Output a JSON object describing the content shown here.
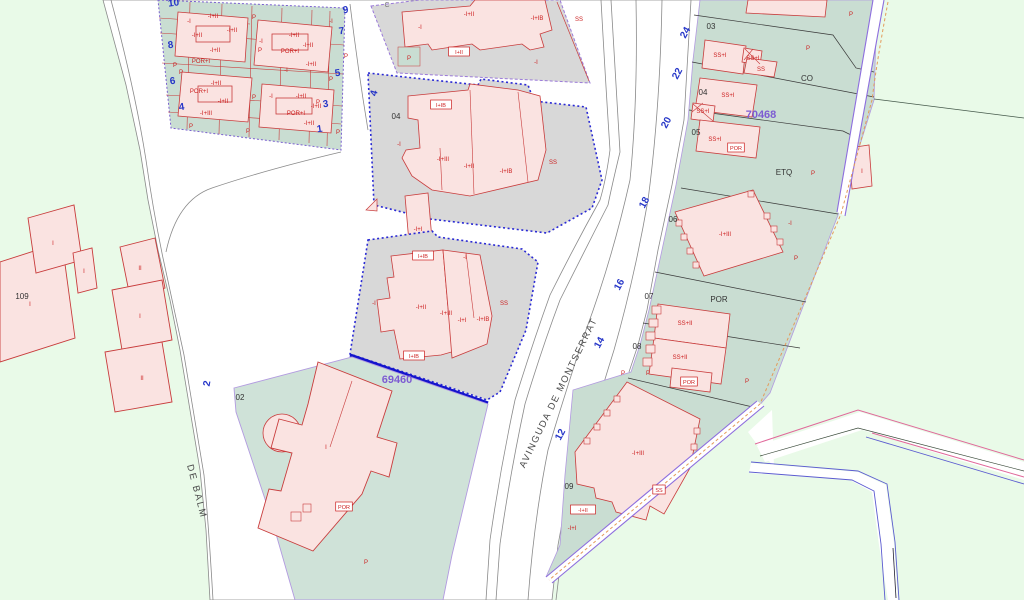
{
  "map": {
    "type": "cadastral-parcel-map",
    "selected_parcel_refs": [
      "69460",
      "70468"
    ]
  },
  "streets": {
    "avinguda": "AVINGUDA DE MONTSERRAT",
    "carrer": "CARRER DE BALM"
  },
  "colors": {
    "background_green": "#e9fae8",
    "parcel_teal": "#c9ddd2",
    "parcel_gray": "#d8d8d8",
    "building_pink": "#fae3e1",
    "building_stroke_red": "#c83c3c",
    "selection_blue_dotted": "#2929d4",
    "selection_blue_thick": "#1414cc",
    "boundary_purple": "#8d6ede",
    "boundary_orange_dash": "#e39a5a",
    "street_number_blue": "#2636c8",
    "parcel_ref_purple": "#7d5cd2"
  },
  "labels": {
    "black": [
      {
        "t": "02",
        "x": 240,
        "y": 400
      },
      {
        "t": "03",
        "x": 711,
        "y": 29
      },
      {
        "t": "04",
        "x": 703,
        "y": 95
      },
      {
        "t": "05",
        "x": 696,
        "y": 135
      },
      {
        "t": "06",
        "x": 673,
        "y": 222
      },
      {
        "t": "07",
        "x": 649,
        "y": 299
      },
      {
        "t": "08",
        "x": 637,
        "y": 349
      },
      {
        "t": "09",
        "x": 569,
        "y": 489
      },
      {
        "t": "04",
        "x": 396,
        "y": 119
      },
      {
        "t": "109",
        "x": 22,
        "y": 299
      },
      {
        "t": "CO",
        "x": 807,
        "y": 81
      },
      {
        "t": "ETQ",
        "x": 784,
        "y": 175
      },
      {
        "t": "POR",
        "x": 719,
        "y": 302
      }
    ],
    "gray": [
      {
        "t": "C",
        "x": 387,
        "y": 7
      }
    ],
    "purple": [
      {
        "t": "69460",
        "x": 397,
        "y": 383
      },
      {
        "t": "70468",
        "x": 761,
        "y": 118
      }
    ],
    "blue": [
      {
        "t": "10",
        "x": 174,
        "y": 6,
        "r": -8
      },
      {
        "t": "9",
        "x": 346,
        "y": 13,
        "r": -8
      },
      {
        "t": "7",
        "x": 342,
        "y": 34,
        "r": -8
      },
      {
        "t": "5",
        "x": 338,
        "y": 76,
        "r": -8
      },
      {
        "t": "3",
        "x": 326,
        "y": 107,
        "r": -8
      },
      {
        "t": "1",
        "x": 320,
        "y": 132,
        "r": -8
      },
      {
        "t": "8",
        "x": 171,
        "y": 48,
        "r": -8
      },
      {
        "t": "6",
        "x": 173,
        "y": 84,
        "r": -8
      },
      {
        "t": "4",
        "x": 182,
        "y": 110,
        "r": -8
      },
      {
        "t": "4",
        "x": 377,
        "y": 94,
        "r": -75
      },
      {
        "t": "2",
        "x": 210,
        "y": 384,
        "r": -80
      },
      {
        "t": "24",
        "x": 688,
        "y": 34,
        "r": -62
      },
      {
        "t": "22",
        "x": 680,
        "y": 75,
        "r": -62
      },
      {
        "t": "20",
        "x": 669,
        "y": 124,
        "r": -62
      },
      {
        "t": "18",
        "x": 647,
        "y": 204,
        "r": -62
      },
      {
        "t": "16",
        "x": 622,
        "y": 286,
        "r": -62
      },
      {
        "t": "14",
        "x": 602,
        "y": 344,
        "r": -62
      },
      {
        "t": "12",
        "x": 563,
        "y": 436,
        "r": -62
      }
    ],
    "red": [
      {
        "t": "-I+II",
        "x": 213,
        "y": 18
      },
      {
        "t": "-I+II",
        "x": 232,
        "y": 32
      },
      {
        "t": "-I+II",
        "x": 197,
        "y": 37
      },
      {
        "t": "-I+II",
        "x": 215,
        "y": 52
      },
      {
        "t": "POR+I",
        "x": 201,
        "y": 63
      },
      {
        "t": "-I+II",
        "x": 294,
        "y": 37
      },
      {
        "t": "-I+II",
        "x": 308,
        "y": 47
      },
      {
        "t": "POR+I",
        "x": 290,
        "y": 53
      },
      {
        "t": "-I+II",
        "x": 311,
        "y": 66
      },
      {
        "t": "-I+II",
        "x": 216,
        "y": 85
      },
      {
        "t": "POR+I",
        "x": 199,
        "y": 93
      },
      {
        "t": "-I+II",
        "x": 223,
        "y": 103
      },
      {
        "t": "-I+III",
        "x": 206,
        "y": 115
      },
      {
        "t": "-I+II",
        "x": 301,
        "y": 98
      },
      {
        "t": "-I+II",
        "x": 316,
        "y": 108
      },
      {
        "t": "POR+I",
        "x": 296,
        "y": 115
      },
      {
        "t": "-I+II",
        "x": 309,
        "y": 125
      },
      {
        "t": "-I",
        "x": 189,
        "y": 23
      },
      {
        "t": "-I",
        "x": 261,
        "y": 43
      },
      {
        "t": "-I",
        "x": 271,
        "y": 98
      },
      {
        "t": "-I",
        "x": 331,
        "y": 23
      },
      {
        "t": "-I",
        "x": 286,
        "y": 72
      },
      {
        "t": "P",
        "x": 254,
        "y": 19
      },
      {
        "t": "P",
        "x": 260,
        "y": 52
      },
      {
        "t": "P",
        "x": 181,
        "y": 74
      },
      {
        "t": "P",
        "x": 254,
        "y": 99
      },
      {
        "t": "P",
        "x": 318,
        "y": 104
      },
      {
        "t": "P",
        "x": 338,
        "y": 134
      },
      {
        "t": "P",
        "x": 175,
        "y": 67
      },
      {
        "t": "P",
        "x": 346,
        "y": 58
      },
      {
        "t": "P",
        "x": 191,
        "y": 128
      },
      {
        "t": "P",
        "x": 248,
        "y": 133
      },
      {
        "t": "P",
        "x": 331,
        "y": 81
      },
      {
        "t": "-I+II",
        "x": 469,
        "y": 16
      },
      {
        "t": "-I+IB",
        "x": 537,
        "y": 20
      },
      {
        "t": "SS",
        "x": 579,
        "y": 21
      },
      {
        "t": "-I",
        "x": 420,
        "y": 29
      },
      {
        "t": "-I",
        "x": 536,
        "y": 64
      },
      {
        "t": "P",
        "x": 409,
        "y": 60
      },
      {
        "t": "-I",
        "x": 399,
        "y": 146
      },
      {
        "t": "-I+III",
        "x": 443,
        "y": 161
      },
      {
        "t": "-I+II",
        "x": 469,
        "y": 168
      },
      {
        "t": "-I+IB",
        "x": 506,
        "y": 173
      },
      {
        "t": "SS",
        "x": 553,
        "y": 164
      },
      {
        "t": "-I+I",
        "x": 418,
        "y": 231
      },
      {
        "t": "-I",
        "x": 374,
        "y": 305
      },
      {
        "t": "-I+II",
        "x": 421,
        "y": 309
      },
      {
        "t": "-I+III",
        "x": 446,
        "y": 315
      },
      {
        "t": "-I+I",
        "x": 462,
        "y": 322
      },
      {
        "t": "-I+IB",
        "x": 483,
        "y": 321
      },
      {
        "t": "SS",
        "x": 504,
        "y": 305
      },
      {
        "t": "-I",
        "x": 465,
        "y": 259
      },
      {
        "t": "I",
        "x": 326,
        "y": 449
      },
      {
        "t": "P",
        "x": 366,
        "y": 564
      },
      {
        "t": "I",
        "x": 53,
        "y": 245
      },
      {
        "t": "I",
        "x": 84,
        "y": 273
      },
      {
        "t": "I",
        "x": 30,
        "y": 306
      },
      {
        "t": "II",
        "x": 140,
        "y": 270
      },
      {
        "t": "I",
        "x": 140,
        "y": 318
      },
      {
        "t": "II",
        "x": 142,
        "y": 380
      },
      {
        "t": "P",
        "x": 851,
        "y": 16
      },
      {
        "t": "SS+I",
        "x": 720,
        "y": 57
      },
      {
        "t": "SS+I",
        "x": 753,
        "y": 60
      },
      {
        "t": "SS",
        "x": 761,
        "y": 71
      },
      {
        "t": "P",
        "x": 808,
        "y": 50
      },
      {
        "t": "SS+I",
        "x": 728,
        "y": 97
      },
      {
        "t": "SS+I",
        "x": 703,
        "y": 113
      },
      {
        "t": "SS+I",
        "x": 715,
        "y": 141
      },
      {
        "t": "P",
        "x": 813,
        "y": 175
      },
      {
        "t": "I",
        "x": 862,
        "y": 173
      },
      {
        "t": "-I+III",
        "x": 725,
        "y": 236
      },
      {
        "t": "P",
        "x": 796,
        "y": 260
      },
      {
        "t": "-I",
        "x": 790,
        "y": 225
      },
      {
        "t": "SS+II",
        "x": 685,
        "y": 325
      },
      {
        "t": "SS+II",
        "x": 680,
        "y": 359
      },
      {
        "t": "P",
        "x": 648,
        "y": 375
      },
      {
        "t": "P",
        "x": 747,
        "y": 383
      },
      {
        "t": "P",
        "x": 623,
        "y": 375
      },
      {
        "t": "-I+III",
        "x": 638,
        "y": 455
      },
      {
        "t": "-I+I",
        "x": 572,
        "y": 530
      }
    ],
    "boxed": [
      {
        "t": "I+II",
        "x": 459,
        "y": 54
      },
      {
        "t": "I+IB",
        "x": 441,
        "y": 107
      },
      {
        "t": "I+IB",
        "x": 423,
        "y": 258
      },
      {
        "t": "I+IB",
        "x": 414,
        "y": 358
      },
      {
        "t": "POR",
        "x": 344,
        "y": 509
      },
      {
        "t": "POR",
        "x": 736,
        "y": 150
      },
      {
        "t": "POR",
        "x": 689,
        "y": 384
      },
      {
        "t": "SS",
        "x": 659,
        "y": 492
      },
      {
        "t": "-I+II",
        "x": 583,
        "y": 512
      }
    ]
  }
}
